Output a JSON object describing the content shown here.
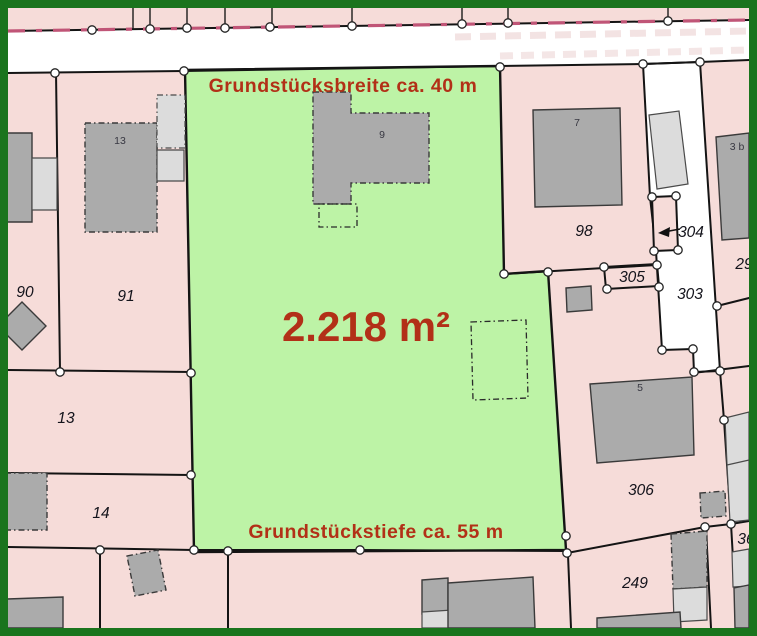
{
  "map": {
    "annotations": {
      "width_label": "Grundstücksbreite ca. 40 m",
      "depth_label": "Grundstückstiefe ca. 55 m",
      "area_label": "2.218 m²"
    },
    "parcels": {
      "p90": "90",
      "p91": "91",
      "p13": "13",
      "p14": "14",
      "p98": "98",
      "p303": "303",
      "p304": "304",
      "p305": "305",
      "p306": "306",
      "p249": "249",
      "p29": "29",
      "p36": "36"
    },
    "buildings": {
      "b13": "13",
      "b9": "9",
      "b7": "7",
      "b5": "5",
      "b3b": "3 b"
    },
    "colors": {
      "highlight_green": "#bdf3a6",
      "parcel_pink": "#f6dcd9",
      "street_white": "#ffffff",
      "building_gray": "#ababab",
      "building_light_gray": "#dcdcdc",
      "border_green": "#1a741d",
      "annotation_red": "#b23017",
      "road_dash_magenta": "#c05577"
    }
  }
}
